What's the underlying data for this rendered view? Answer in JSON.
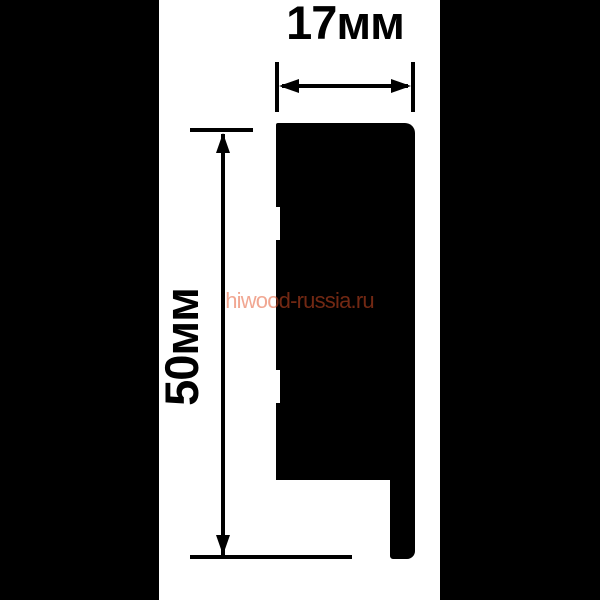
{
  "diagram": {
    "type": "product-dimension-drawing",
    "subject": "skirting-board profile cross-section",
    "width_dimension": {
      "label": "17мм",
      "value_mm": 17
    },
    "height_dimension": {
      "label": "50мм",
      "value_mm": 50
    }
  },
  "watermark": {
    "text": "hiwood-russia.ru"
  },
  "colors": {
    "letterbox_bars": "#000000",
    "canvas_background": "#ffffff",
    "profile_fill": "#000000",
    "dimension_lines": "#000000",
    "watermark_base": "#e44f26"
  }
}
